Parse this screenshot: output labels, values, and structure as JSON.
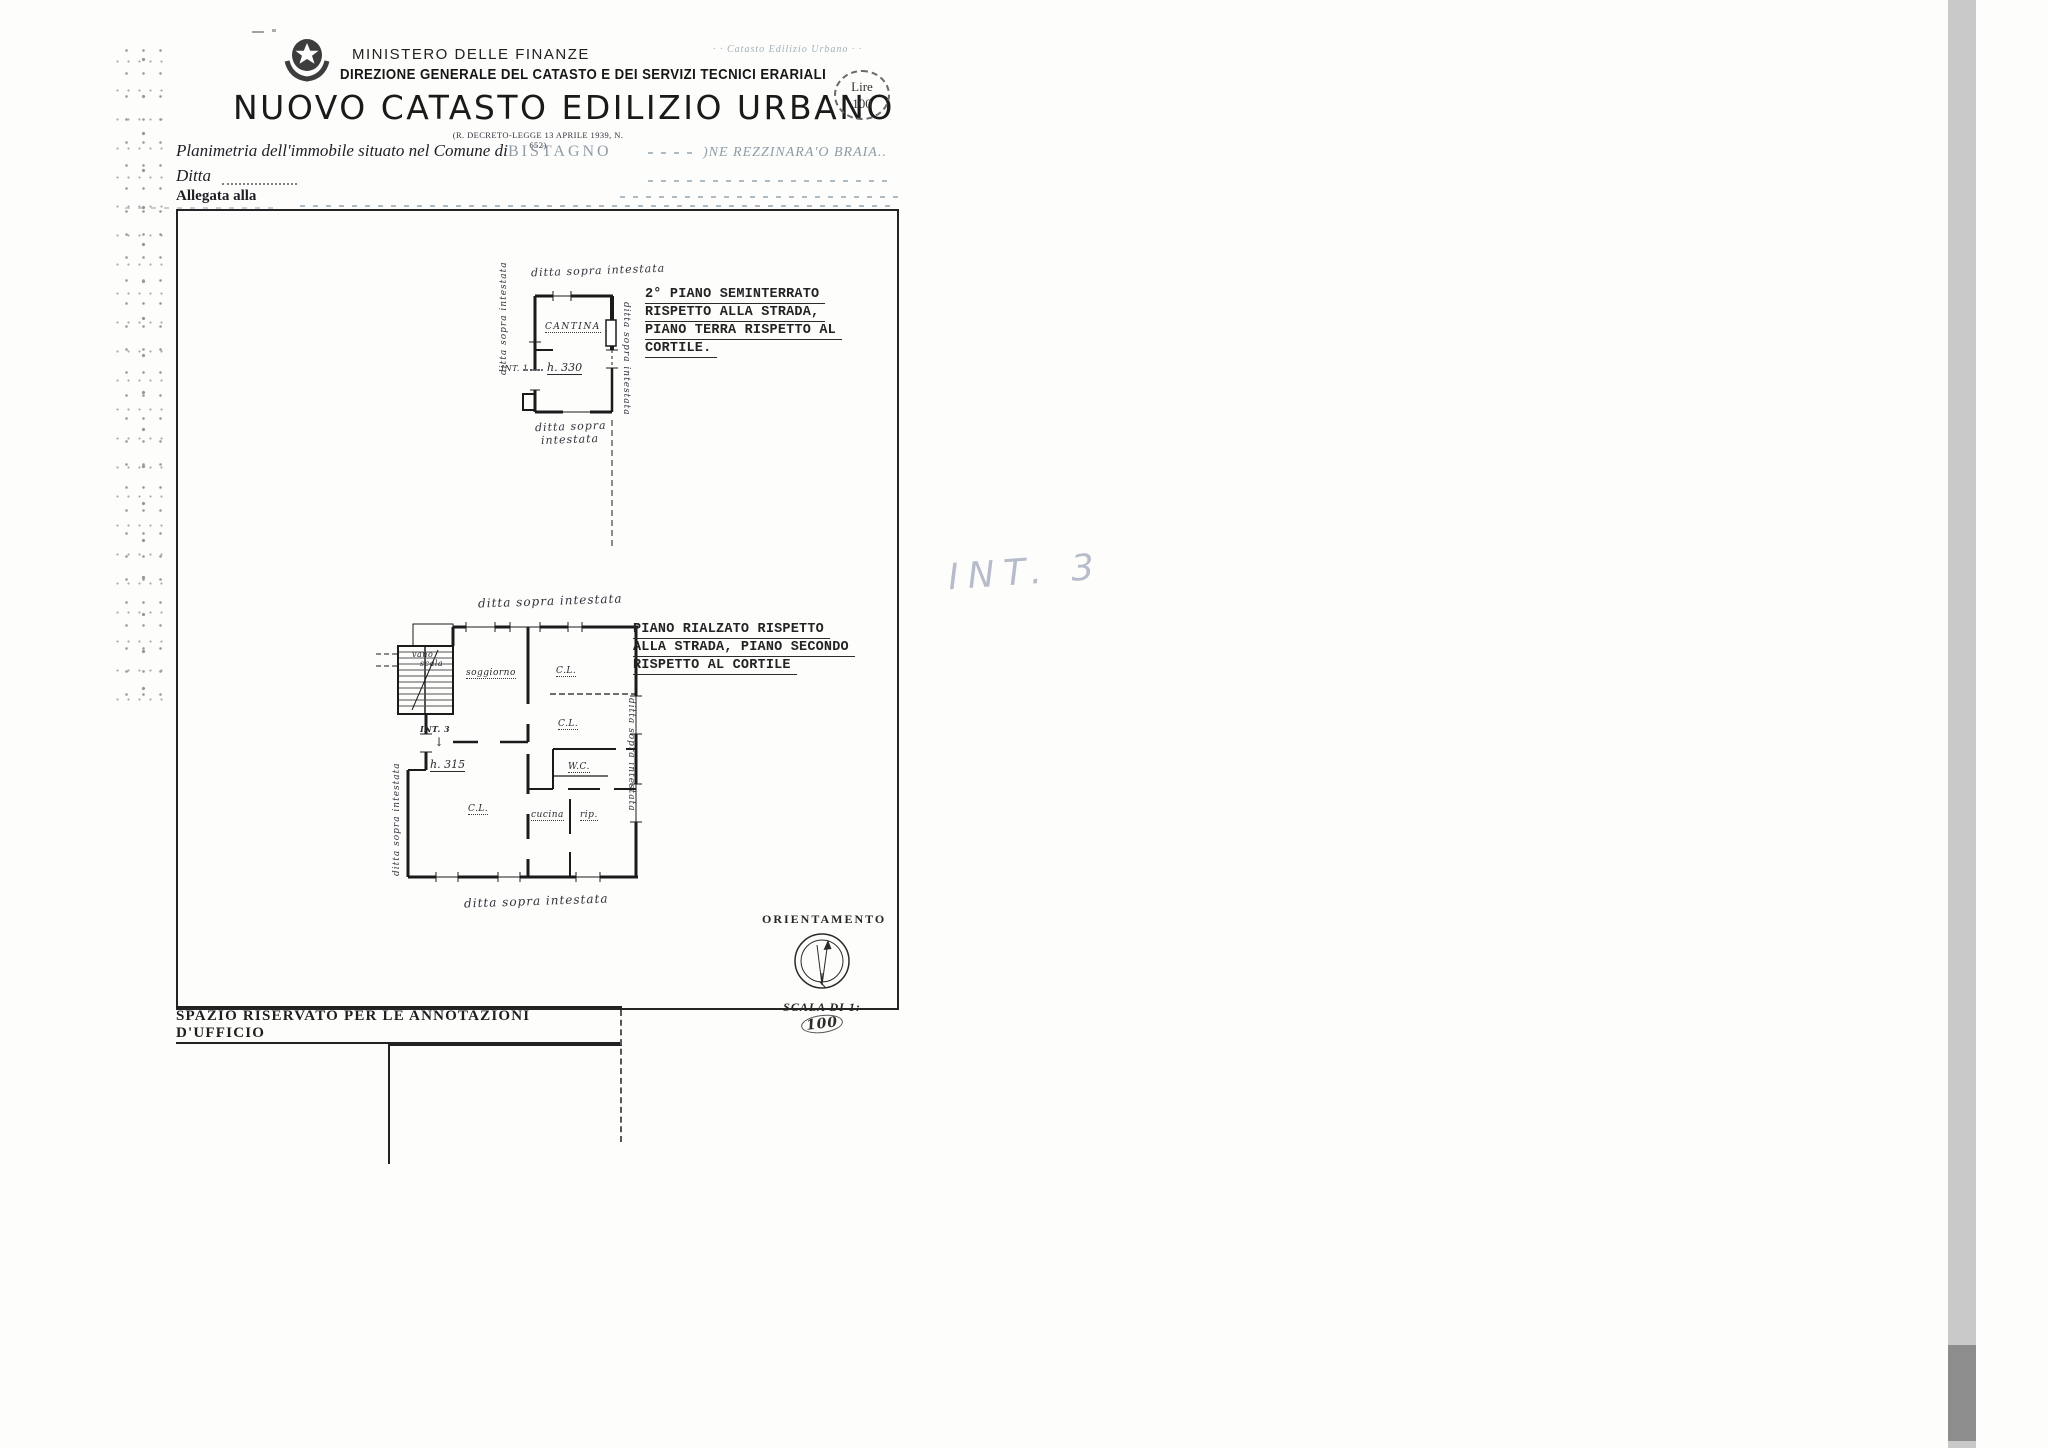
{
  "header": {
    "ministry": "MINISTERO DELLE FINANZE",
    "directorate": "DIREZIONE GENERALE DEL CATASTO E DEI SERVIZI TECNICI ERARIALI",
    "title": "NUOVO CATASTO EDILIZIO URBANO",
    "decree_note": "(R. DECRETO-LEGGE 13 APRILE 1939, N. 652)",
    "faint_corner_note": "· · Catasto Edilizio Urbano · ·",
    "stamp": {
      "currency": "Lire",
      "amount": "100"
    }
  },
  "form": {
    "planimetria_label": "Planimetria dell'immobile situato nel Comune di",
    "comune_value": "BISTAGNO",
    "locality_note": ")NE REZZINARA'O BRAIA..",
    "ditta_label": "Ditta",
    "allegata_label": "Allegata alla"
  },
  "upper_plan": {
    "note_top": "ditta sopra intestata",
    "note_left": "ditta sopra intestata",
    "note_right": "ditta sopra intestata",
    "note_bottom_1": "ditta sopra",
    "note_bottom_2": "intestata",
    "room_label": "CANTINA",
    "interno_label": "INT. 1",
    "height_label": "h. 330",
    "caption_lines": [
      "2° PIANO SEMINTERRATO",
      "RISPETTO ALLA STRADA,",
      "PIANO TERRA RISPETTO AL",
      "CORTILE."
    ]
  },
  "lower_plan": {
    "note_top": "ditta sopra intestata",
    "note_left": "ditta sopra intestata",
    "note_right": "ditta sopra intestata",
    "note_bottom": "ditta sopra intestata",
    "rooms": {
      "stairwell_1": "vano",
      "stairwell_2": "scala",
      "living": "soggiorno",
      "bedroom_top": "C.L.",
      "bedroom_mid": "C.L.",
      "wc": "W.C.",
      "bedroom_bottom": "C.L.",
      "kitchen": "cucina",
      "storage": "rip.",
      "arrow": "↓"
    },
    "interno_label": "INT. 3",
    "height_label": "h. 315",
    "caption_lines": [
      "PIANO RIALZATO RISPETTO",
      "ALLA STRADA, PIANO SECONDO",
      "RISPETTO AL CORTILE"
    ]
  },
  "pencil_note": "INT. 3",
  "orientation": {
    "title": "ORIENTAMENTO",
    "scale_prefix": "SCALA DI 1:",
    "scale_value": "100"
  },
  "office_box": {
    "title": "SPAZIO RISERVATO PER LE ANNOTAZIONI D'UFFICIO"
  },
  "colors": {
    "ink": "#1c1c1c",
    "faint_ink": "#8d9ca6",
    "pencil": "#abb1c3",
    "scan_strip": "#c9c9c9"
  }
}
